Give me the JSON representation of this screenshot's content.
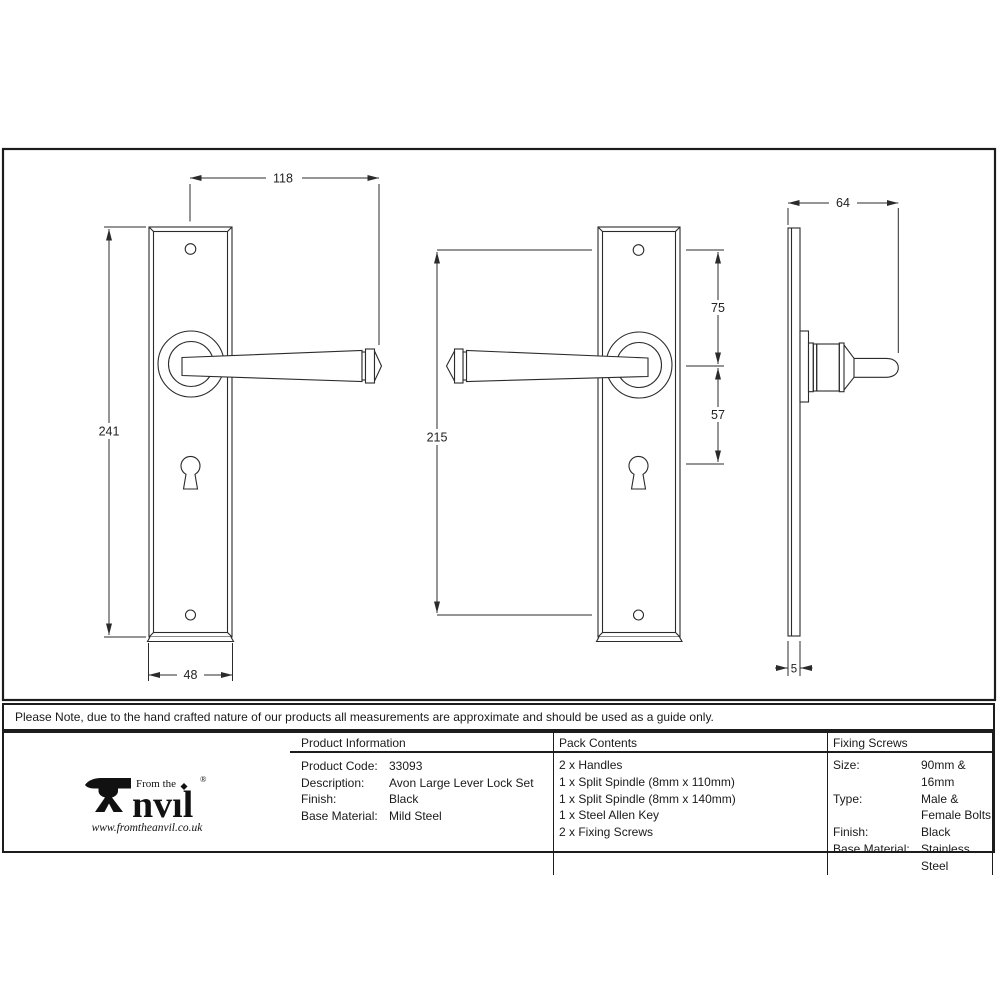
{
  "dimensions": {
    "front_view": {
      "width_to_handle_tip": "118",
      "plate_height": "241",
      "plate_width": "48"
    },
    "reverse_view": {
      "screw_centres": "215",
      "screw_to_handle_centre": "75",
      "handle_centre_to_keyhole": "57"
    },
    "side_view": {
      "projection": "64",
      "plate_thickness": "5"
    }
  },
  "note": {
    "text": "Please Note, due to the hand crafted nature of our products all measurements are approximate and should be used as a guide only."
  },
  "table": {
    "product_information": {
      "header": "Product Information",
      "rows": [
        {
          "label": "Product Code:",
          "value": "33093"
        },
        {
          "label": "Description:",
          "value": "Avon Large Lever Lock Set"
        },
        {
          "label": "Finish:",
          "value": "Black"
        },
        {
          "label": "Base Material:",
          "value": "Mild Steel"
        }
      ]
    },
    "pack_contents": {
      "header": "Pack Contents",
      "items": [
        "2 x Handles",
        "1 x Split Spindle (8mm x 110mm)",
        "1 x Split Spindle (8mm x 140mm)",
        "1 x Steel Allen Key",
        "2 x Fixing Screws"
      ]
    },
    "fixing_screws": {
      "header": "Fixing Screws",
      "rows": [
        {
          "label": "Size:",
          "value": "90mm & 16mm"
        },
        {
          "label": "Type:",
          "value": "Male & Female Bolts"
        },
        {
          "label": "Finish:",
          "value": "Black"
        },
        {
          "label": "Base Material:",
          "value": "Stainless Steel"
        }
      ]
    }
  },
  "logo": {
    "prefix": "From the",
    "brand": "nvıl",
    "registered": "®",
    "website": "www.fromtheanvil.co.uk"
  }
}
